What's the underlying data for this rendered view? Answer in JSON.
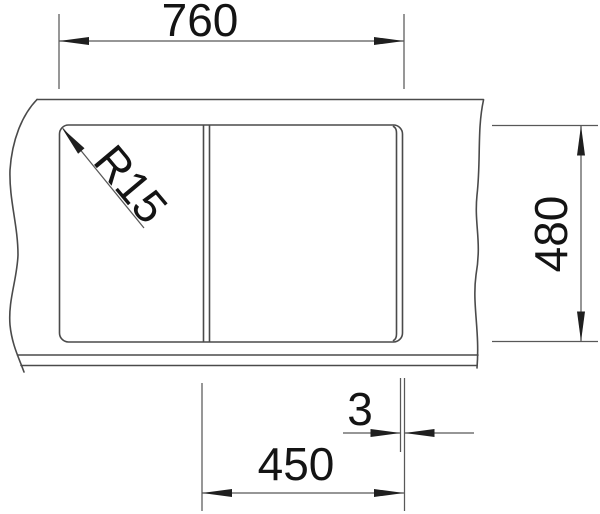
{
  "colors": {
    "background": "#ffffff",
    "outline": "#4a4a4a",
    "dimension_lines": "#585858",
    "arrows": "#1f1f1f",
    "text": "#141414"
  },
  "dimensions": {
    "top_width": "760",
    "right_depth": "480",
    "bottom_bowl_width": "450",
    "bottom_gap": "3",
    "corner_radius": "R15"
  }
}
